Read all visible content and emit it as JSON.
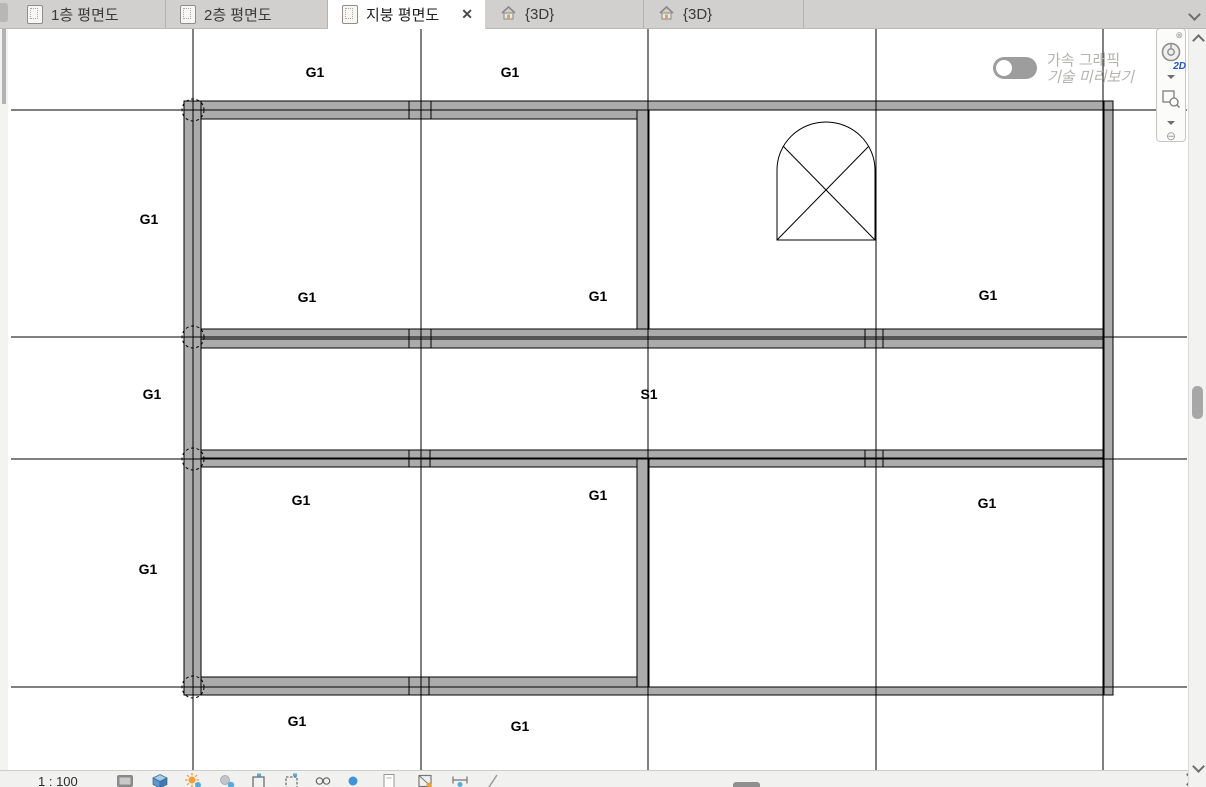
{
  "tab_bar": {
    "overflow_icon": "chevron-down-icon",
    "close_glyph": "✕",
    "tabs": [
      {
        "name": "tab-floor1-plan",
        "label": "1층 평면도",
        "icon": "floor-plan-icon",
        "active": false
      },
      {
        "name": "tab-floor2-plan",
        "label": "2층 평면도",
        "icon": "floor-plan-icon",
        "active": false
      },
      {
        "name": "tab-roof-plan",
        "label": "지붕 평면도",
        "icon": "floor-plan-icon",
        "active": true,
        "closable": true
      },
      {
        "name": "tab-3d-view-1",
        "label": "{3D}",
        "icon": "house-icon",
        "active": false
      },
      {
        "name": "tab-3d-view-2",
        "label": "{3D}",
        "icon": "house-icon",
        "active": false
      }
    ]
  },
  "graphics_toggle": {
    "line1": "가속 그래픽",
    "line2": "기술 미리보기",
    "state": "off"
  },
  "navigation_bar": {
    "mode_label": "2D",
    "icons": [
      "close-icon",
      "steering-wheel-icon",
      "dropdown-icon",
      "zoom-region-icon",
      "dropdown-icon",
      "zoom-out-icon"
    ]
  },
  "view_control_bar": {
    "scale_label": "1 : 100",
    "icons": [
      "detail-level-icon",
      "visual-style-icon",
      "sun-path-icon",
      "shadows-icon",
      "crop-view-icon",
      "show-crop-region-icon",
      "temporary-hide-isolate-icon",
      "reveal-hidden-elements-icon",
      "temporary-view-properties-icon",
      "show-analytical-model-icon",
      "reveal-constraints-icon",
      "worksharing-display-icon"
    ]
  },
  "colors": {
    "beam_fill": "#ababab",
    "line": "#000000",
    "toggle_off": "#9d9d9d",
    "nav_2d_text": "#1d58c6"
  },
  "drawing": {
    "grid": {
      "vertical_x": [
        193,
        421,
        648,
        876,
        1103
      ],
      "horizontal_y": [
        110,
        337,
        459,
        687
      ],
      "v_extent": [
        28,
        770
      ],
      "h_extent": [
        11,
        1187
      ]
    },
    "beams": [
      {
        "x": 184,
        "y": 101,
        "w": 464,
        "h": 18,
        "split_y": 110
      },
      {
        "x": 648,
        "y": 101,
        "w": 465,
        "h": 9
      },
      {
        "x": 184,
        "y": 329,
        "w": 929,
        "h": 19,
        "split_y": 339
      },
      {
        "x": 184,
        "y": 450,
        "w": 929,
        "h": 17,
        "split_y": 458
      },
      {
        "x": 184,
        "y": 677,
        "w": 464,
        "h": 18,
        "split_y": 687
      },
      {
        "x": 648,
        "y": 687,
        "w": 465,
        "h": 8
      },
      {
        "x": 184,
        "y": 101,
        "w": 17,
        "h": 594
      },
      {
        "x": 637,
        "y": 110,
        "w": 12,
        "h": 219
      },
      {
        "x": 637,
        "y": 459,
        "w": 12,
        "h": 228
      },
      {
        "x": 1104,
        "y": 101,
        "w": 9,
        "h": 594
      }
    ],
    "joints": [
      {
        "x": 409,
        "y1": 101,
        "y2": 119
      },
      {
        "x": 431,
        "y1": 101,
        "y2": 119
      },
      {
        "x": 409,
        "y1": 329,
        "y2": 348
      },
      {
        "x": 431,
        "y1": 329,
        "y2": 348
      },
      {
        "x": 865,
        "y1": 329,
        "y2": 348
      },
      {
        "x": 883,
        "y1": 329,
        "y2": 348
      },
      {
        "x": 409,
        "y1": 450,
        "y2": 467
      },
      {
        "x": 430,
        "y1": 450,
        "y2": 467
      },
      {
        "x": 865,
        "y1": 450,
        "y2": 467
      },
      {
        "x": 883,
        "y1": 450,
        "y2": 467
      },
      {
        "x": 409,
        "y1": 677,
        "y2": 695
      },
      {
        "x": 429,
        "y1": 677,
        "y2": 695
      }
    ],
    "columns": [
      {
        "cx": 193,
        "cy": 110,
        "r": 11
      },
      {
        "cx": 193,
        "cy": 337,
        "r": 11
      },
      {
        "cx": 193,
        "cy": 459,
        "r": 11
      },
      {
        "cx": 193,
        "cy": 687,
        "r": 11
      }
    ],
    "opening_symbol": {
      "left": 777,
      "right": 875,
      "bottom": 240,
      "spring": 170,
      "apex": 122,
      "diagonals": [
        [
          777,
          240,
          869,
          146
        ],
        [
          783,
          146,
          875,
          240
        ]
      ]
    },
    "labels": [
      {
        "text": "G1",
        "x": 315,
        "y": 72
      },
      {
        "text": "G1",
        "x": 510,
        "y": 72
      },
      {
        "text": "G1",
        "x": 149,
        "y": 219
      },
      {
        "text": "G1",
        "x": 307,
        "y": 297
      },
      {
        "text": "G1",
        "x": 598,
        "y": 296
      },
      {
        "text": "G1",
        "x": 988,
        "y": 295
      },
      {
        "text": "G1",
        "x": 152,
        "y": 394
      },
      {
        "text": "S1",
        "x": 649,
        "y": 394
      },
      {
        "text": "G1",
        "x": 301,
        "y": 500
      },
      {
        "text": "G1",
        "x": 598,
        "y": 495
      },
      {
        "text": "G1",
        "x": 987,
        "y": 503
      },
      {
        "text": "G1",
        "x": 148,
        "y": 569
      },
      {
        "text": "G1",
        "x": 297,
        "y": 721
      },
      {
        "text": "G1",
        "x": 520,
        "y": 726
      }
    ]
  }
}
